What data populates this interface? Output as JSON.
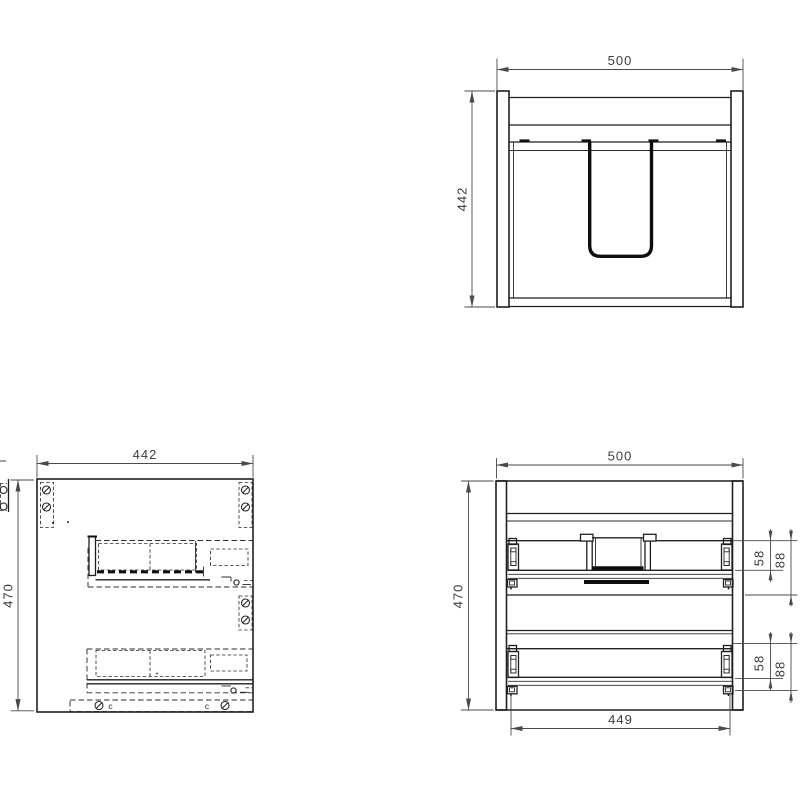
{
  "front_exterior_view": {
    "width_label": "500",
    "height_label": "442"
  },
  "side_view": {
    "width_label": "442",
    "height_label": "470",
    "screw_note_left": "c",
    "screw_note_right": "c"
  },
  "front_interior_view": {
    "width_label": "500",
    "height_label": "470",
    "drawer_inner_width_label": "449",
    "upper_drawer": {
      "side_height_label": "58",
      "total_height_label": "88"
    },
    "lower_drawer": {
      "side_height_label": "58",
      "total_height_label": "88"
    }
  },
  "colors": {
    "object_line": "#1f1f1f",
    "dimension_line": "#4a4a4a",
    "label_text": "#3c3c3c",
    "background": "#ffffff"
  }
}
